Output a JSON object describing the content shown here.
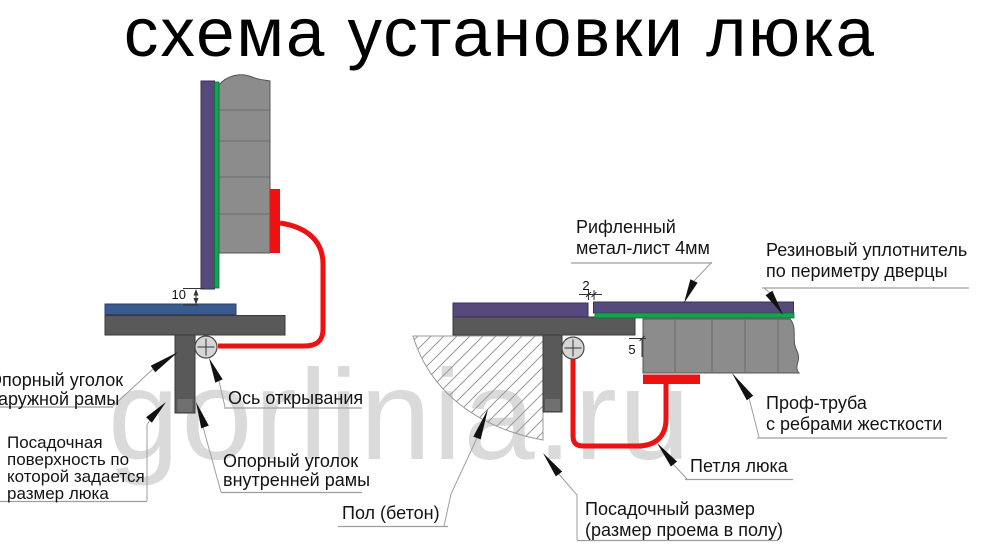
{
  "title": "схема установки люка",
  "watermark": "gorlinia.ru",
  "colors": {
    "door_leaf_purple": "#564a7d",
    "rubber_seal_green": "#16a351",
    "steel_gray": "#8c8c8c",
    "frame_dark_gray": "#595959",
    "support_angle_blue": "#3b5a8d",
    "hinge_red": "#ee1111"
  },
  "dimensions": {
    "door_to_angle_gap_mm": "10",
    "top_gap_mm": "2",
    "side_gap_mm": "5"
  },
  "labels": {
    "outer_angle": {
      "lines": [
        "Опорный уголок",
        "наружной рамы"
      ]
    },
    "seat_surface": {
      "lines": [
        "Посадочная",
        "поверхность по",
        "которой задается",
        "размер люка"
      ]
    },
    "axis": {
      "lines": [
        "Ось открывания"
      ]
    },
    "inner_angle": {
      "lines": [
        "Опорный уголок",
        "внутренней рамы"
      ]
    },
    "floor": {
      "lines": [
        "Пол (бетон)"
      ]
    },
    "seat_size": {
      "lines": [
        "Посадочный размер",
        "(размер проема в полу)"
      ]
    },
    "hinge": {
      "lines": [
        "Петля люка"
      ]
    },
    "prof_tube": {
      "lines": [
        "Проф-труба",
        "с ребрами жесткости"
      ]
    },
    "sheet": {
      "lines": [
        "Рифленный",
        "метал-лист 4мм"
      ]
    },
    "seal": {
      "lines": [
        "Резиновый уплотнитель",
        "по периметру дверцы"
      ]
    }
  }
}
